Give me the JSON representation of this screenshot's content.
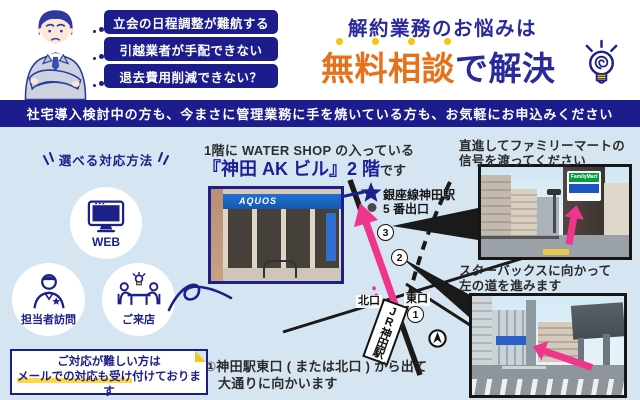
{
  "header": {
    "pains": [
      "立会の日程調整が難航する",
      "引越業者が手配できない",
      "退去費用削減できない？"
    ],
    "title_top": "解約業務のお悩みは",
    "title_highlight": "無料相談",
    "title_tail": "で解決",
    "banner": "社宅導入検討中の方も、今まさに管理業務に手を焼いている方も、お気軽にお申込みください"
  },
  "methods": {
    "heading": "選べる対応方法",
    "items": [
      {
        "label": "WEB",
        "icon": "monitor-icon"
      },
      {
        "label": "担当者訪問",
        "icon": "visitor-icon"
      },
      {
        "label": "ご来店",
        "icon": "meeting-icon"
      }
    ],
    "note_line1": "ご対応が難しい方は",
    "note_line2_highlight": "メールでの対応も受け",
    "note_line2_rest": "付けております"
  },
  "location": {
    "line1": "1階に WATER SHOP の入っている",
    "line2_building": "『神田 AK ビル』2 階",
    "line2_tail": "です"
  },
  "map": {
    "subway_line1": "銀座線神田駅",
    "subway_line2": "5 番出口",
    "north_exit": "北口",
    "east_exit": "東口",
    "jr_station": "JR神田駅",
    "step_numbers": [
      "1",
      "2",
      "3"
    ]
  },
  "steps": {
    "step1_line1": "①神田駅東口 ( または北口 ) から出て",
    "step1_line2": "大通りに向かいます",
    "step2_line1": "直進してファミリーマートの",
    "step2_line2": "信号を渡ってください",
    "step3_line1": "スターバックスに向かって",
    "step3_line2": "左の道を進みます"
  },
  "photos": {
    "storefront_sign": "AQUOS",
    "familymart_sign": "FamilyMart"
  },
  "colors": {
    "navy": "#1c1c8c",
    "orange": "#e8701a",
    "pink": "#f0368c",
    "light_blue": "#d6e5f2",
    "highlight_yellow": "#ffd83d"
  }
}
